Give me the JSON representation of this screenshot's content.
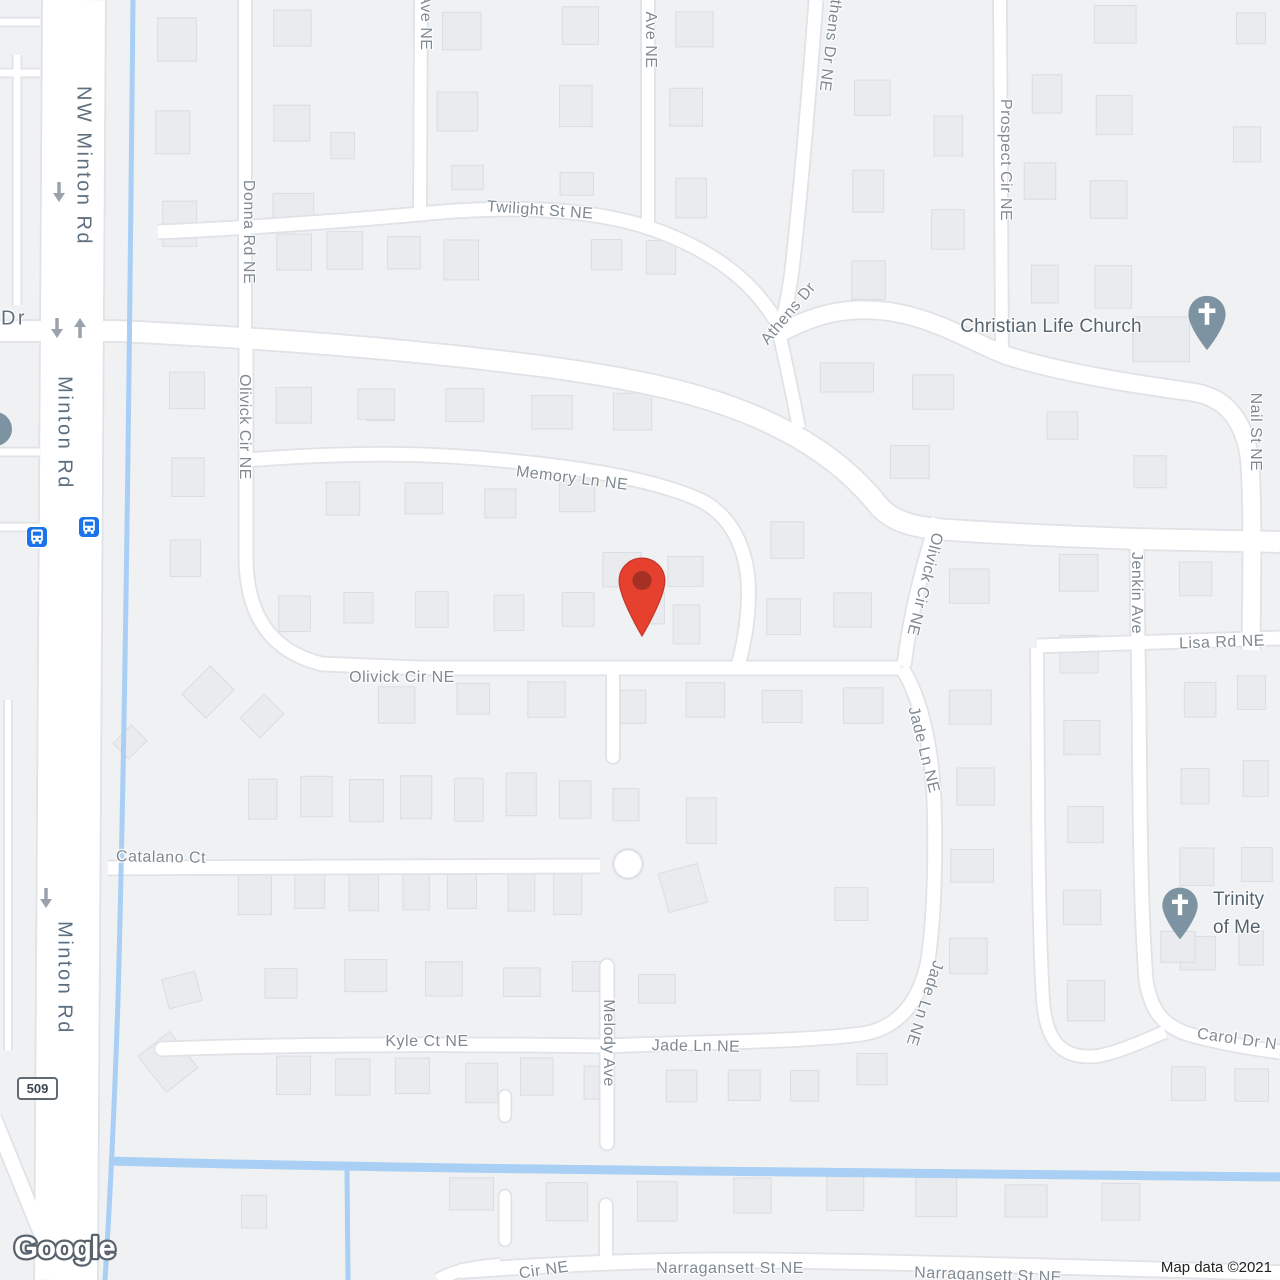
{
  "map": {
    "streets": [
      {
        "id": "nw-minton-rd",
        "label": "NW Minton Rd"
      },
      {
        "id": "minton-rd-1",
        "label": "Minton Rd"
      },
      {
        "id": "minton-rd-2",
        "label": "Minton Rd"
      },
      {
        "id": "dr",
        "label": "Dr"
      },
      {
        "id": "donna-rd-ne",
        "label": "Donna Rd NE"
      },
      {
        "id": "ave-ne-1",
        "label": "Ave NE"
      },
      {
        "id": "ave-ne-2",
        "label": "Ave NE"
      },
      {
        "id": "twilight-st-ne",
        "label": "Twilight St NE"
      },
      {
        "id": "athens-dr-ne",
        "label": "Athens Dr NE"
      },
      {
        "id": "athens-dr",
        "label": "Athens Dr"
      },
      {
        "id": "prospect-cir-ne",
        "label": "Prospect Cir NE"
      },
      {
        "id": "nail-st-ne",
        "label": "Nail St NE"
      },
      {
        "id": "memory-ln-ne",
        "label": "Memory Ln NE"
      },
      {
        "id": "olivick-w",
        "label": "Olivick Cir NE"
      },
      {
        "id": "olivick-e",
        "label": "Olivick Cir NE"
      },
      {
        "id": "olivick-s",
        "label": "Olivick Cir NE"
      },
      {
        "id": "jenkin-ave",
        "label": "Jenkin Ave"
      },
      {
        "id": "lisa-rd-ne",
        "label": "Lisa Rd NE"
      },
      {
        "id": "jade-n",
        "label": "Jade Ln NE"
      },
      {
        "id": "jade-mid",
        "label": "Jade Ln NE"
      },
      {
        "id": "jade-s",
        "label": "Jade Ln NE"
      },
      {
        "id": "catalano-ct",
        "label": "Catalano Ct"
      },
      {
        "id": "melody-ave",
        "label": "Melody Ave"
      },
      {
        "id": "kyle-ct-ne",
        "label": "Kyle Ct NE"
      },
      {
        "id": "carol-dr-n",
        "label": "Carol Dr N"
      },
      {
        "id": "cir-ne",
        "label": "Cir NE"
      },
      {
        "id": "narragansett-1",
        "label": "Narragansett St NE"
      },
      {
        "id": "narragansett-2",
        "label": "Narragansett St NE"
      }
    ],
    "pois": {
      "christian_life_church": {
        "name": "Christian Life Church"
      },
      "trinity": {
        "line1": "Trinity",
        "line2": "of Me"
      }
    },
    "route_shield": "509",
    "transit": {
      "bus_stop_count": 2
    },
    "marker": {
      "type": "red-location-pin"
    },
    "attribution": "Map data ©2021",
    "logo": "Google",
    "colors": {
      "marker_red": "#e6412f",
      "marker_red_inner": "#a53125",
      "marker_red_edge": "#c5352a",
      "poi_pin_slate": "#7e93a2",
      "bus_blue": "#1a73e8",
      "water": "#a9cff4",
      "road_fill": "#ffffff",
      "road_casing": "#dfe2e6",
      "building": "#e9ebee",
      "building_edge": "#dadde1",
      "land": "#eff1f3",
      "arrow_gray": "#9aa3ab"
    }
  }
}
